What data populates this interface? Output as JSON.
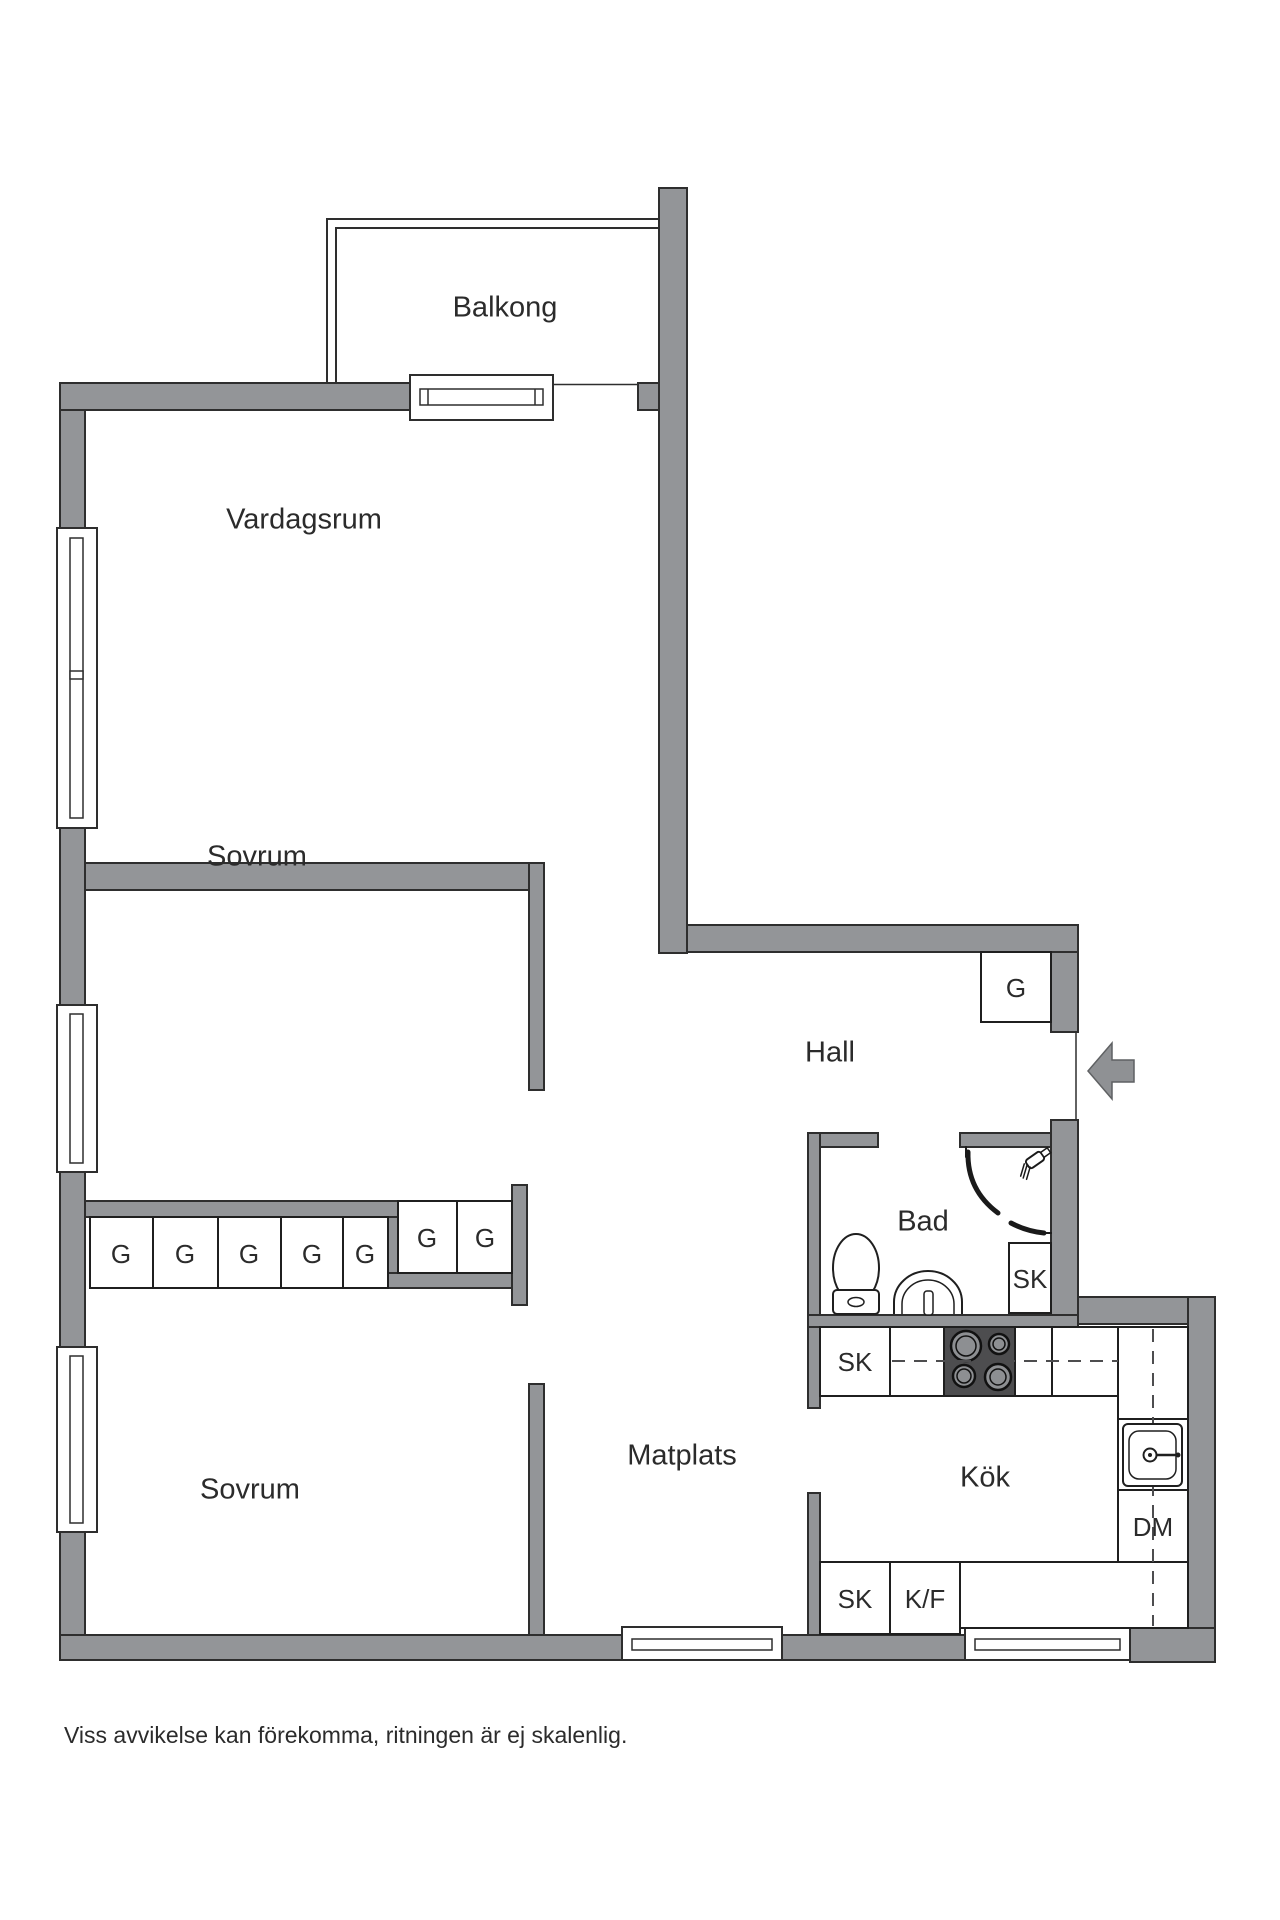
{
  "rooms": {
    "balkong": "Balkong",
    "vardagsrum": "Vardagsrum",
    "sovrum_1": "Sovrum",
    "hall": "Hall",
    "bad": "Bad",
    "matplats": "Matplats",
    "kok": "Kök",
    "sovrum_2": "Sovrum"
  },
  "fixtures": {
    "hall_wardrobe": "G",
    "bedroom_wardrobes": [
      "G",
      "G",
      "G",
      "G",
      "G"
    ],
    "corridor_wardrobes": [
      "G",
      "G"
    ],
    "bathroom_cabinet": "SK",
    "kitchen_cabinet_upper": "SK",
    "kitchen_cabinet_lower": "SK",
    "fridge_freezer": "K/F",
    "dishwasher": "DM"
  },
  "disclaimer": "Viss avvikelse kan förekomma, ritningen är ej skalenlig.",
  "colors": {
    "wall": "#939598",
    "outline": "#2e2e2e",
    "stove_plate": "#4d4d4f",
    "burner": "#8d8f92",
    "text": "#2b2b2b",
    "background": "#ffffff"
  }
}
